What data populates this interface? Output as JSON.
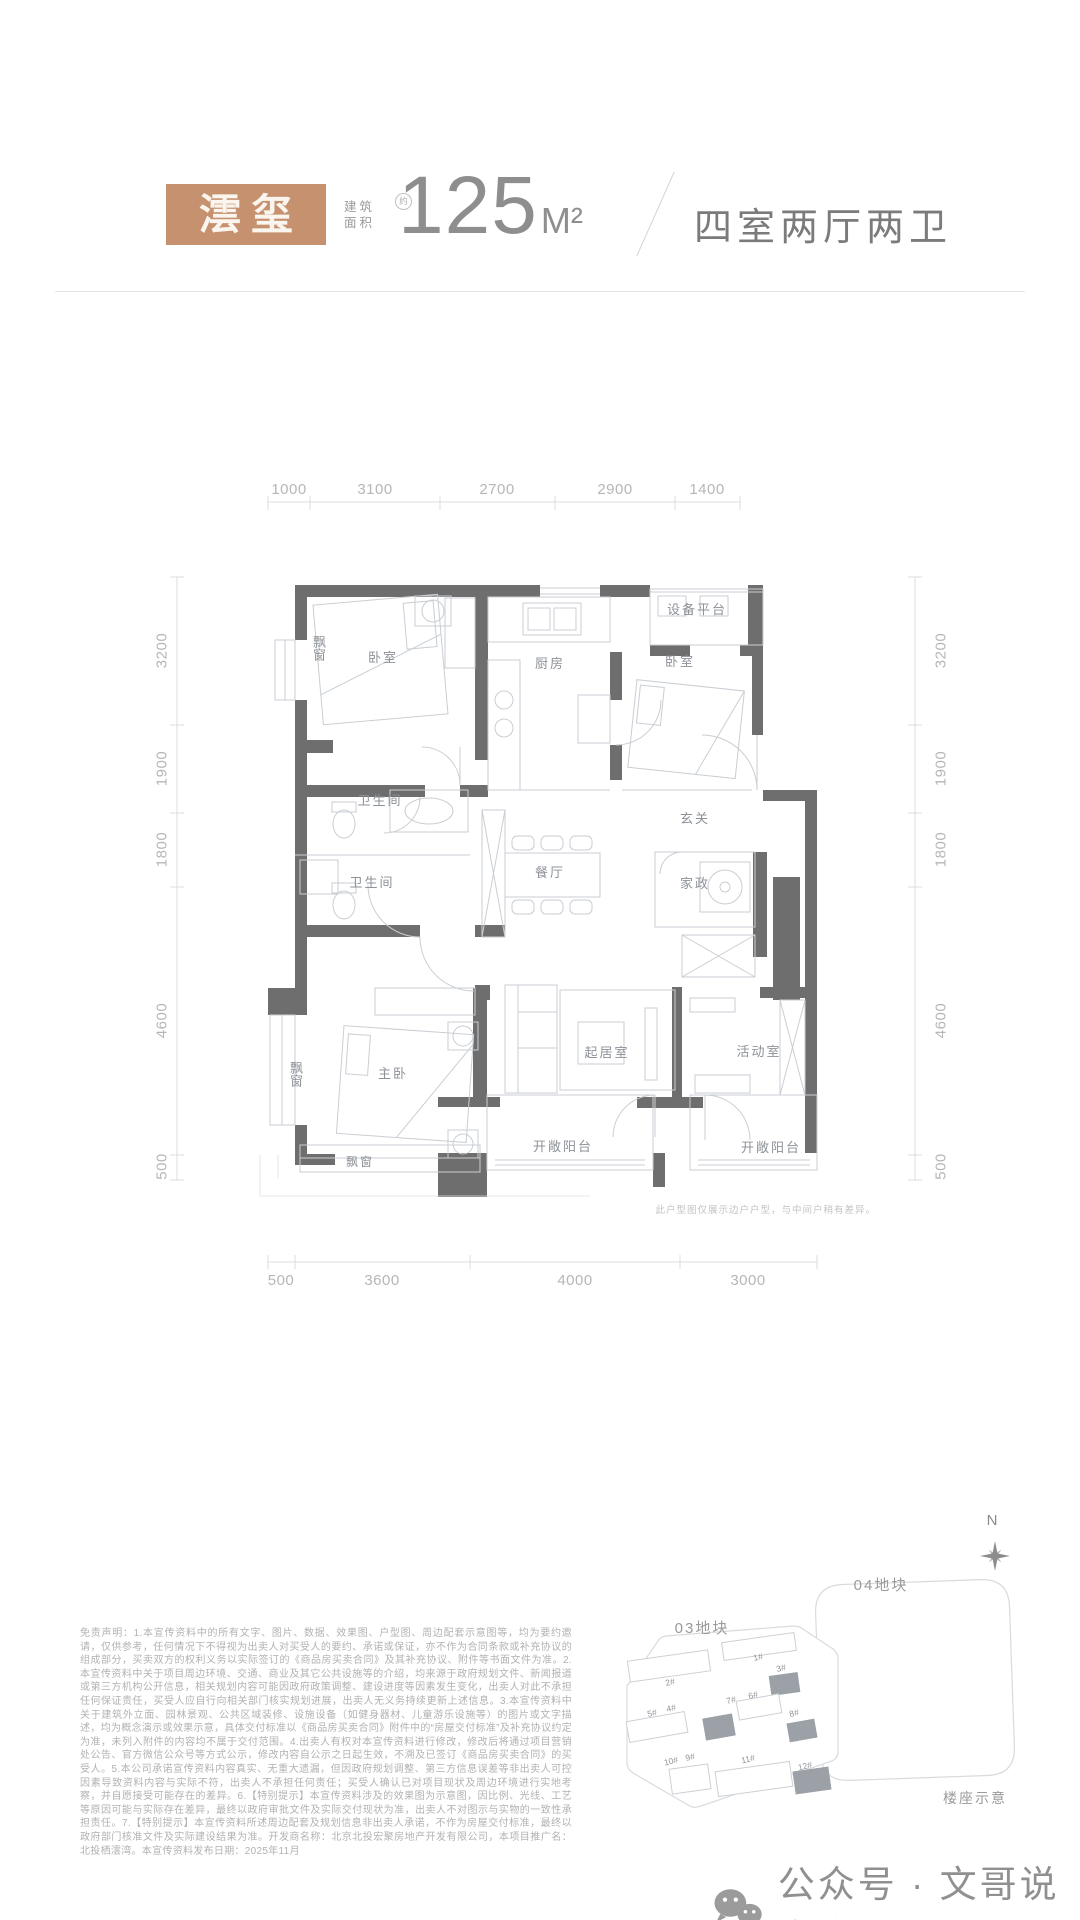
{
  "header": {
    "unit_name": "澐玺",
    "area_label_line1": "建筑",
    "area_label_line2": "面积",
    "area_approx": "约",
    "area_value": "125",
    "area_unit": "M²",
    "layout_desc": "四室两厅两卫"
  },
  "floorplan": {
    "dims_top": [
      "1000",
      "3100",
      "2700",
      "2900",
      "1400"
    ],
    "dims_left": [
      "3200",
      "1900",
      "1800",
      "4600",
      "500"
    ],
    "dims_right": [
      "3200",
      "1900",
      "1800",
      "4600",
      "500"
    ],
    "dims_bottom": [
      "500",
      "3600",
      "4000",
      "3000"
    ],
    "rooms": {
      "bay_bedroom": "飘窗",
      "bedroom1": "卧室",
      "kitchen": "厨房",
      "equipment_platform": "设备平台",
      "bedroom2": "卧室",
      "bathroom1": "卫生间",
      "bathroom2": "卫生间",
      "dining": "餐厅",
      "foyer": "玄关",
      "housekeeping": "家政",
      "master_bedroom": "主卧",
      "bay_master_left": "飘窗",
      "living": "起居室",
      "activity": "活动室",
      "balcony1": "开敞阳台",
      "balcony2": "开敞阳台",
      "bay_master_bottom": "飘窗"
    },
    "note": "此户型图仅展示边户户型，与中间户稍有差异。"
  },
  "disclaimer": "免责声明：1.本宣传资料中的所有文字、图片、数据、效果图、户型图、周边配套示意图等，均为要约邀请，仅供参考，任何情况下不得视为出卖人对买受人的要约、承诺或保证，亦不作为合同条款或补充协议的组成部分，买卖双方的权利义务以实际签订的《商品房买卖合同》及其补充协议、附件等书面文件为准。2.本宣传资料中关于项目周边环境、交通、商业及其它公共设施等的介绍，均来源于政府规划文件、新闻报道或第三方机构公开信息，相关规划内容可能因政府政策调整、建设进度等因素发生变化，出卖人对此不承担任何保证责任，买受人应自行向相关部门核实规划进展，出卖人无义务持续更新上述信息。3.本宣传资料中关于建筑外立面、园林景观、公共区域装修、设施设备（如健身器材、儿童游乐设施等）的图片或文字描述，均为概念演示或效果示意，具体交付标准以《商品房买卖合同》附件中的“房屋交付标准”及补充协议约定为准，未列入附件的内容均不属于交付范围。4.出卖人有权对本宣传资料进行修改，修改后将通过项目营销处公告、官方微信公众号等方式公示，修改内容自公示之日起生效，不溯及已签订《商品房买卖合同》的买受人。5.本公司承诺宣传资料内容真实、无重大遗漏，但因政府规划调整、第三方信息误差等非出卖人可控因素导致资料内容与实际不符，出卖人不承担任何责任；买受人确认已对项目现状及周边环境进行实地考察，并自愿接受可能存在的差异。6.【特别提示】本宣传资料涉及的效果图为示意图，因比例、光线、工艺等原因可能与实际存在差异，最终以政府审批文件及实际交付现状为准，出卖人不对图示与实物的一致性承担责任。7.【特别提示】本宣传资料所述周边配套及规划信息非出卖人承诺，不作为房屋交付标准，最终以政府部门核准文件及实际建设结果为准。开发商名称：北京北投宏聚房地产开发有限公司，本项目推广名：北投栖澐湾。本宣传资料发布日期：2025年11月",
  "site_plan": {
    "compass_label": "N",
    "plot_03": "03地块",
    "plot_04": "04地块",
    "caption": "楼座示意",
    "buildings": [
      "1#",
      "2#",
      "3#",
      "4#",
      "5#",
      "6#",
      "7#",
      "8#",
      "9#",
      "10#",
      "11#",
      "12#"
    ]
  },
  "footer": {
    "text": "公众号 · 文哥说京房"
  },
  "colors": {
    "accent_bronze": "#c5916f",
    "wall_gray": "#6e6e6e",
    "thin_line": "#c9ced3",
    "dim_text": "#b6b6b6"
  }
}
